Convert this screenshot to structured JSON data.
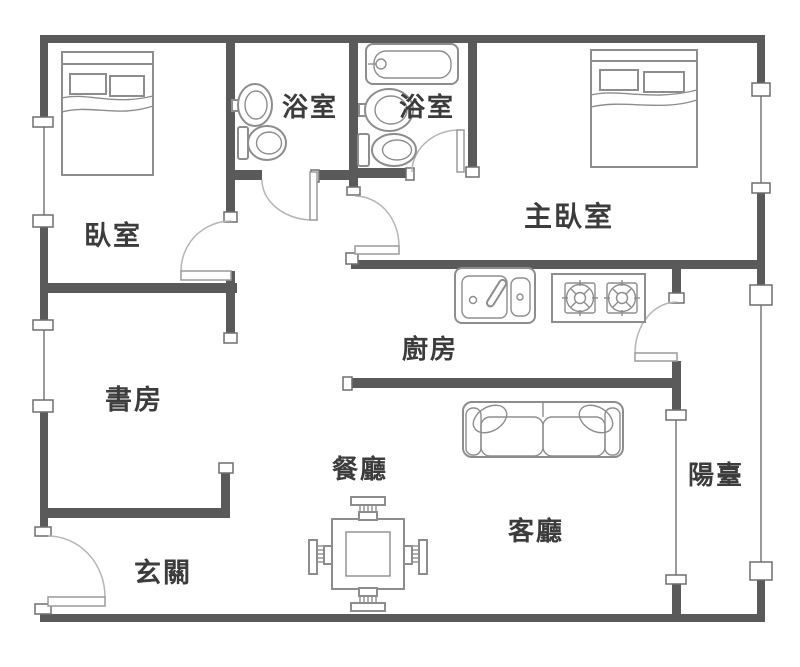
{
  "plan": {
    "type": "apartment-floor-plan",
    "rooms": {
      "bedroom": "臥室",
      "bathroom1": "浴室",
      "bathroom2": "浴室",
      "master_bedroom": "主臥室",
      "kitchen": "廚房",
      "study": "書房",
      "dining": "餐廳",
      "living": "客廳",
      "entrance": "玄關",
      "balcony": "陽臺"
    },
    "fixture_icons": [
      "double-bed-icon",
      "double-bed-icon",
      "washbasin-icon",
      "toilet-icon",
      "bathtub-icon",
      "washbasin-icon",
      "toilet-icon",
      "kitchen-sink-icon",
      "gas-stove-icon",
      "sofa-icon",
      "dining-table-icon",
      "chair-icon"
    ],
    "colors": {
      "wall": "#5a5a5a",
      "fixture_outline": "#8d8d8d",
      "door_arc": "#b5b5b5",
      "label_text": "#3c3c3c",
      "background": "#ffffff"
    }
  }
}
